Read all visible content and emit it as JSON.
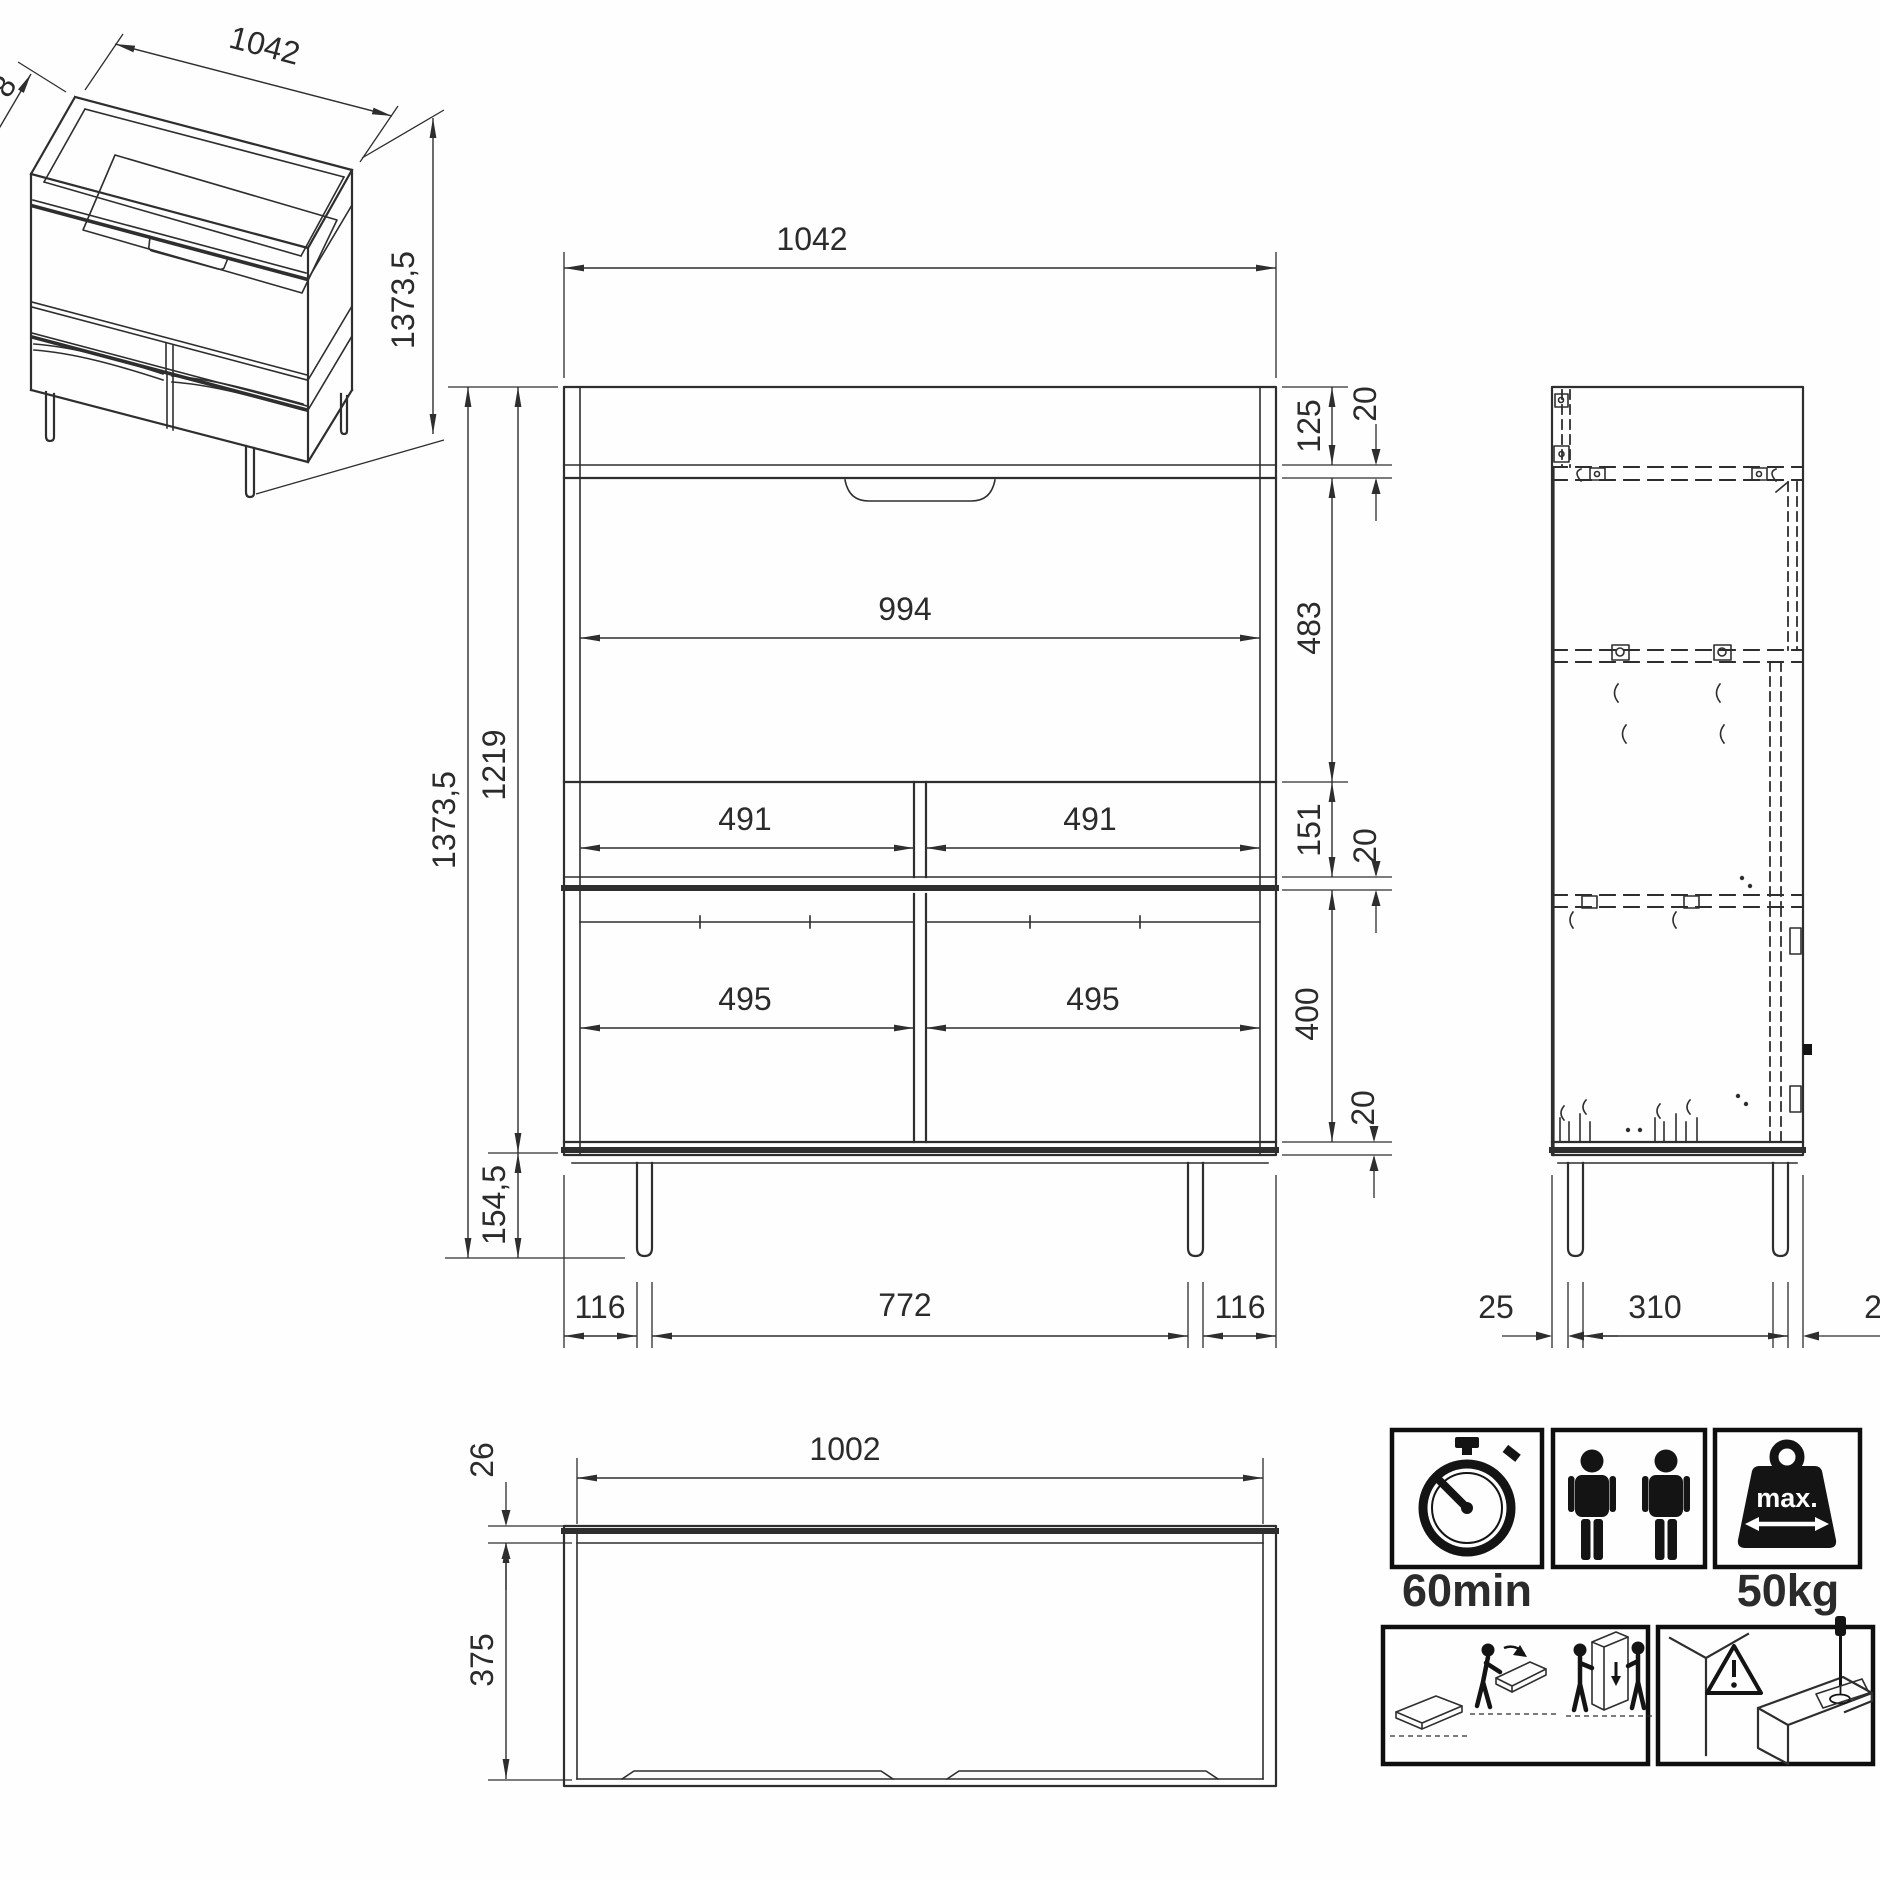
{
  "drawing": {
    "iso": {
      "width": "1042",
      "height": "1373,5",
      "depth_partial": "8"
    },
    "front": {
      "width_top": "1042",
      "height_total": "1373,5",
      "height_body": "1219",
      "height_legs": "154,5",
      "width_inner": "994",
      "shelf_left": "491",
      "shelf_right": "491",
      "door_left": "495",
      "door_right": "495",
      "seg_crown": "125",
      "seg_flap": "483",
      "seg_shelf": "151",
      "seg_doors": "400",
      "t_top": "20",
      "t_mid": "20",
      "t_bottom": "20",
      "foot_left": "116",
      "foot_span": "772",
      "foot_right": "116"
    },
    "side": {
      "front_inset": "25",
      "leg_span": "310",
      "back_inset_partial": "2"
    },
    "top": {
      "back_thickness": "26",
      "width_inner": "1002",
      "depth": "375"
    }
  },
  "badges": {
    "time": "60min",
    "weight": "50kg",
    "weight_max": "max."
  }
}
